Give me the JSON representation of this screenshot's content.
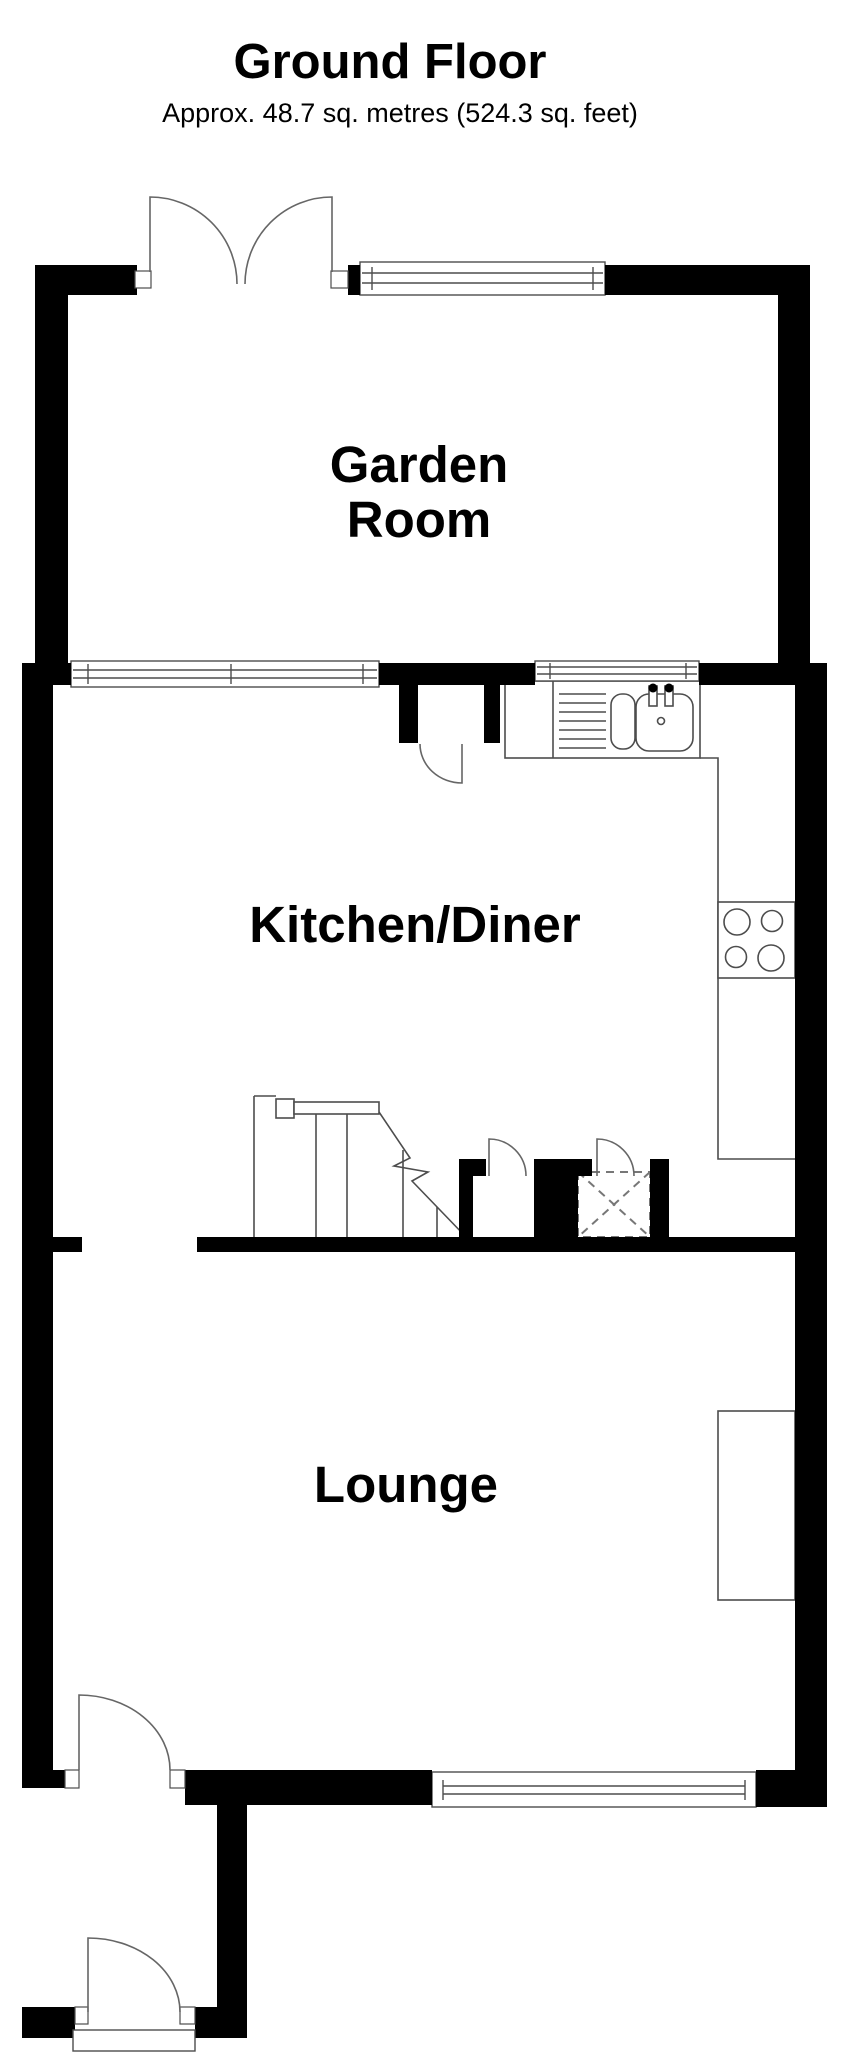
{
  "header": {
    "title": "Ground Floor",
    "subtitle": "Approx. 48.7 sq. metres (524.3 sq. feet)"
  },
  "rooms": [
    {
      "name": "garden-room",
      "label": "Garden\nRoom"
    },
    {
      "name": "kitchen-diner",
      "label": "Kitchen/Diner"
    },
    {
      "name": "lounge",
      "label": "Lounge"
    }
  ],
  "colors": {
    "wall": "#000000",
    "fixture_line": "#4d4d4d",
    "door_line": "#666666",
    "background": "#ffffff"
  }
}
